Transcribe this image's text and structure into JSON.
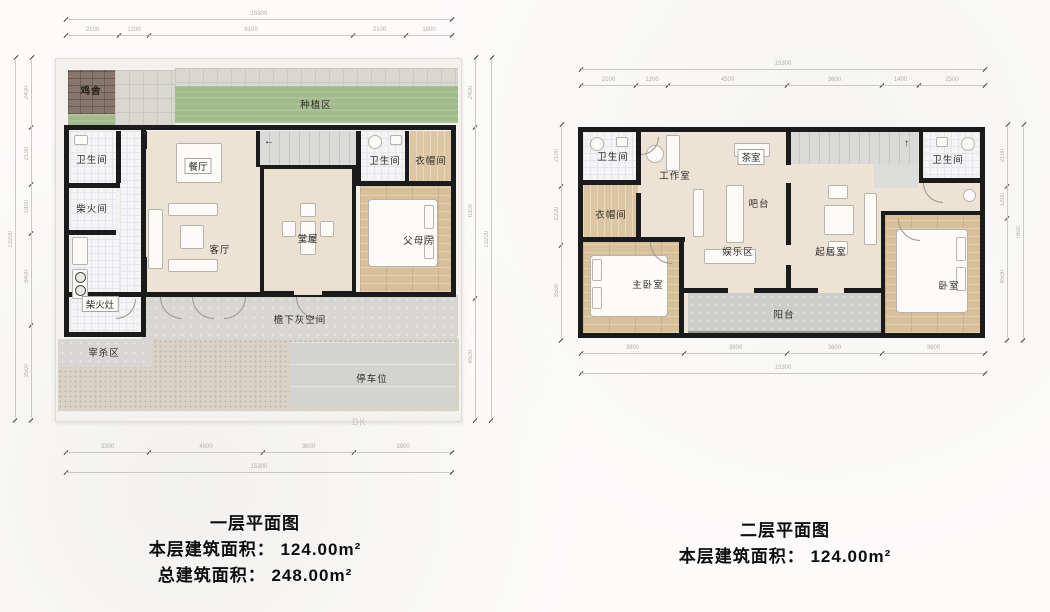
{
  "floor1": {
    "title": "一层平面图",
    "area_line1": "本层建筑面积： 124.00m²",
    "area_line2": "总建筑面积： 248.00m²",
    "dk": "DK",
    "rooms": {
      "jishe": "鸡舍",
      "zhongzhiqu": "种植区",
      "weishengjian1": "卫生间",
      "canting": "餐厅",
      "chaihuojian": "柴火间",
      "keting": "客厅",
      "tangwu": "堂屋",
      "weishengjian2": "卫生间",
      "yimaojian": "衣帽间",
      "fumufang": "父母房",
      "chaihuozao": "柴火灶",
      "yanxiahui": "檐下灰空间",
      "zaishaqu": "宰杀区",
      "tingchewei": "停车位"
    },
    "dims": {
      "top_total": "15300",
      "top_segs": [
        "2100",
        "1200",
        "8100",
        "2100",
        "1800"
      ],
      "bottom_segs": [
        "3300",
        "4500",
        "3600",
        "3900"
      ],
      "bottom_total": "15300",
      "left_segs": [
        "2400",
        "2100",
        "1800",
        "3400",
        "3500"
      ],
      "left_total": "13200",
      "right_segs": [
        "2400",
        "6300",
        "4500"
      ],
      "right_total": "13200"
    }
  },
  "floor2": {
    "title": "二层平面图",
    "area_line1": "本层建筑面积： 124.00m²",
    "rooms": {
      "weishengjian1": "卫生间",
      "gongzuoshi": "工作室",
      "chashi": "茶室",
      "weishengjian2": "卫生间",
      "yimaojian": "衣帽间",
      "batai": "吧台",
      "yulequ": "娱乐区",
      "qijushi": "起居室",
      "zhuwoshi": "主卧室",
      "yangtai": "阳台",
      "woshi": "卧室"
    },
    "dims": {
      "top_total": "15300",
      "top_segs": [
        "2100",
        "1200",
        "4500",
        "3600",
        "1400",
        "2500"
      ],
      "bottom_segs": [
        "3900",
        "3900",
        "3600",
        "3900"
      ],
      "bottom_total": "15300",
      "left_segs": [
        "2100",
        "2200",
        "3500"
      ],
      "right_segs": [
        "2100",
        "1200",
        "4500"
      ],
      "right_total": "7800"
    }
  },
  "icons": {
    "stair_arrow_left": "←",
    "stair_arrow_up": "↑"
  },
  "colors": {
    "wall": "#1b1b1b",
    "floor_cream": "#ece3d4",
    "floor_wood": "#d8bf98",
    "planting_green": "#a1ba8c",
    "coop_brown": "#87766b",
    "gray_space": "#d7d6d3",
    "tile": "#f4f4f6"
  }
}
